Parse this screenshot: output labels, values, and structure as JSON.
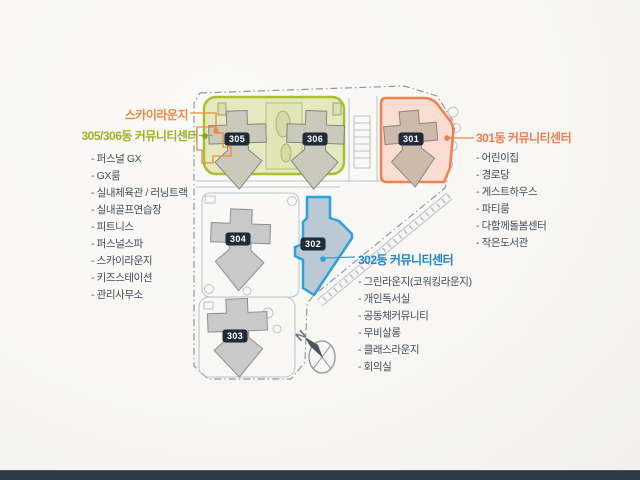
{
  "page": {
    "background": "#f7f6f3",
    "footer_bar_color": "#2d3b49"
  },
  "plan": {
    "north_label": "N",
    "building_badges": [
      "305",
      "306",
      "301",
      "304",
      "302",
      "303"
    ],
    "colors": {
      "zone_305_306_fill": "#e4e9c2",
      "zone_305_306_border": "#a9bf2d",
      "zone_301_fill": "#f8ddd0",
      "zone_301_border": "#ee8150",
      "zone_302_fill": "#bbc9d4",
      "zone_302_border": "#2aa2dc",
      "badge_bg": "#1f2d3a",
      "badge_text": "#ffffff"
    }
  },
  "legend_305": {
    "callout_sky_lounge": "스카이라운지",
    "callout_sky_lounge_color": "#f0883a",
    "title": "305/306동 커뮤니티센터",
    "title_color": "#9eb227",
    "items": [
      "- 퍼스널 GX",
      "- GX룸",
      "- 실내체육관 / 러닝트랙",
      "- 실내골프연습장",
      "- 피트니스",
      "- 퍼스널스파",
      "- 스카이라운지",
      "- 키즈스테이션",
      "- 관리사무소"
    ]
  },
  "legend_301": {
    "title": "301동 커뮤니티센터",
    "title_color": "#ed7e54",
    "items": [
      "- 어린이집",
      "- 경로당",
      "- 게스트하우스",
      "- 파티룸",
      "- 다함께돌봄센터",
      "- 작은도서관"
    ]
  },
  "legend_302": {
    "title": "302동 커뮤니티센터",
    "title_color": "#1d86c8",
    "items": [
      "- 그린라운지(코워킹라운지)",
      "- 개인독서실",
      "- 공동체커뮤니티",
      "- 무비살롱",
      "- 클래스라운지",
      "- 회의실"
    ]
  }
}
